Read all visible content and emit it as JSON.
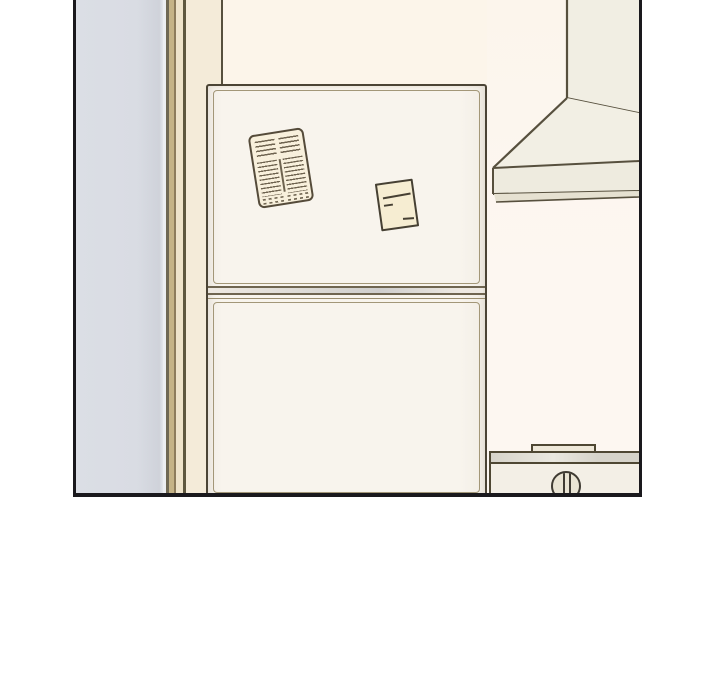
{
  "scene": {
    "type": "comic-panel",
    "setting": "kitchen interior, line-art illustration, no text",
    "objects": [
      {
        "name": "side-door-panel",
        "description": "grey-blue panel at left edge"
      },
      {
        "name": "door-frame",
        "description": "vertical tan and beige frame strips"
      },
      {
        "name": "refrigerator",
        "parts": [
          "upper-door",
          "lower-door",
          "door-seam",
          "door-inset-lines"
        ]
      },
      {
        "name": "menu-flyer-magnet",
        "description": "printed flyer with two columns of lines pinned to upper door"
      },
      {
        "name": "sticky-note-magnet",
        "description": "pale yellow note with short handwritten lines"
      },
      {
        "name": "range-hood",
        "parts": [
          "chimney-duct",
          "sloped-canopy",
          "front-band",
          "bottom-lip"
        ]
      },
      {
        "name": "washing-machine",
        "parts": [
          "top-tab",
          "lid-band",
          "body",
          "control-knob"
        ]
      }
    ],
    "colors": {
      "page_bg": "#ffffff",
      "panel_border": "#1a191d",
      "wall": "#fcf5ea",
      "wall_right": "#fdf7f1",
      "side_door": "#d9dce3",
      "frame_tan": "#c5b386",
      "frame_beige": "#eee3ca",
      "frame_cream": "#f4ebd9",
      "line_dark": "#57503e",
      "fridge_face": "#f8f4ed",
      "fridge_line": "#4b4435",
      "inset_line": "#a39778",
      "flyer_fill": "#f8f0dc",
      "flyer_ink": "#6f6450",
      "note_fill": "#f6edd2",
      "note_ink": "#464033",
      "hood_face": "#f1eee3",
      "hood_band": "#eeebdf",
      "hood_lip": "#e6e1d1",
      "appliance_body": "#f3efe6",
      "appliance_band": "#d6d3ca",
      "knob_fill": "#e9e4d4"
    }
  }
}
